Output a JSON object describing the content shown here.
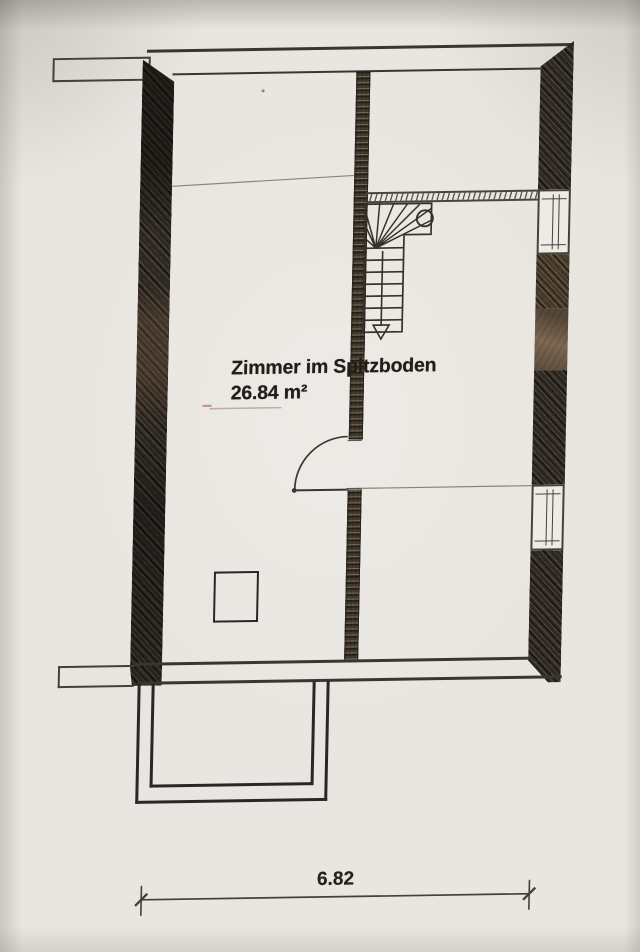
{
  "plan": {
    "room_label": "Zimmer im Spitzboden",
    "room_area": "26.84 m²",
    "dimension_total": "6.82"
  },
  "symbols": {
    "stairs": "winder-staircase-down-arrow",
    "door": "door-swing-left",
    "windows": "window-symbol"
  },
  "colors": {
    "paper": "#e9e6e1",
    "ink": "#2e2a26",
    "wall_dark": "#2e2924",
    "wall_brown": "#55432e",
    "soft_line": "#8a8379"
  }
}
